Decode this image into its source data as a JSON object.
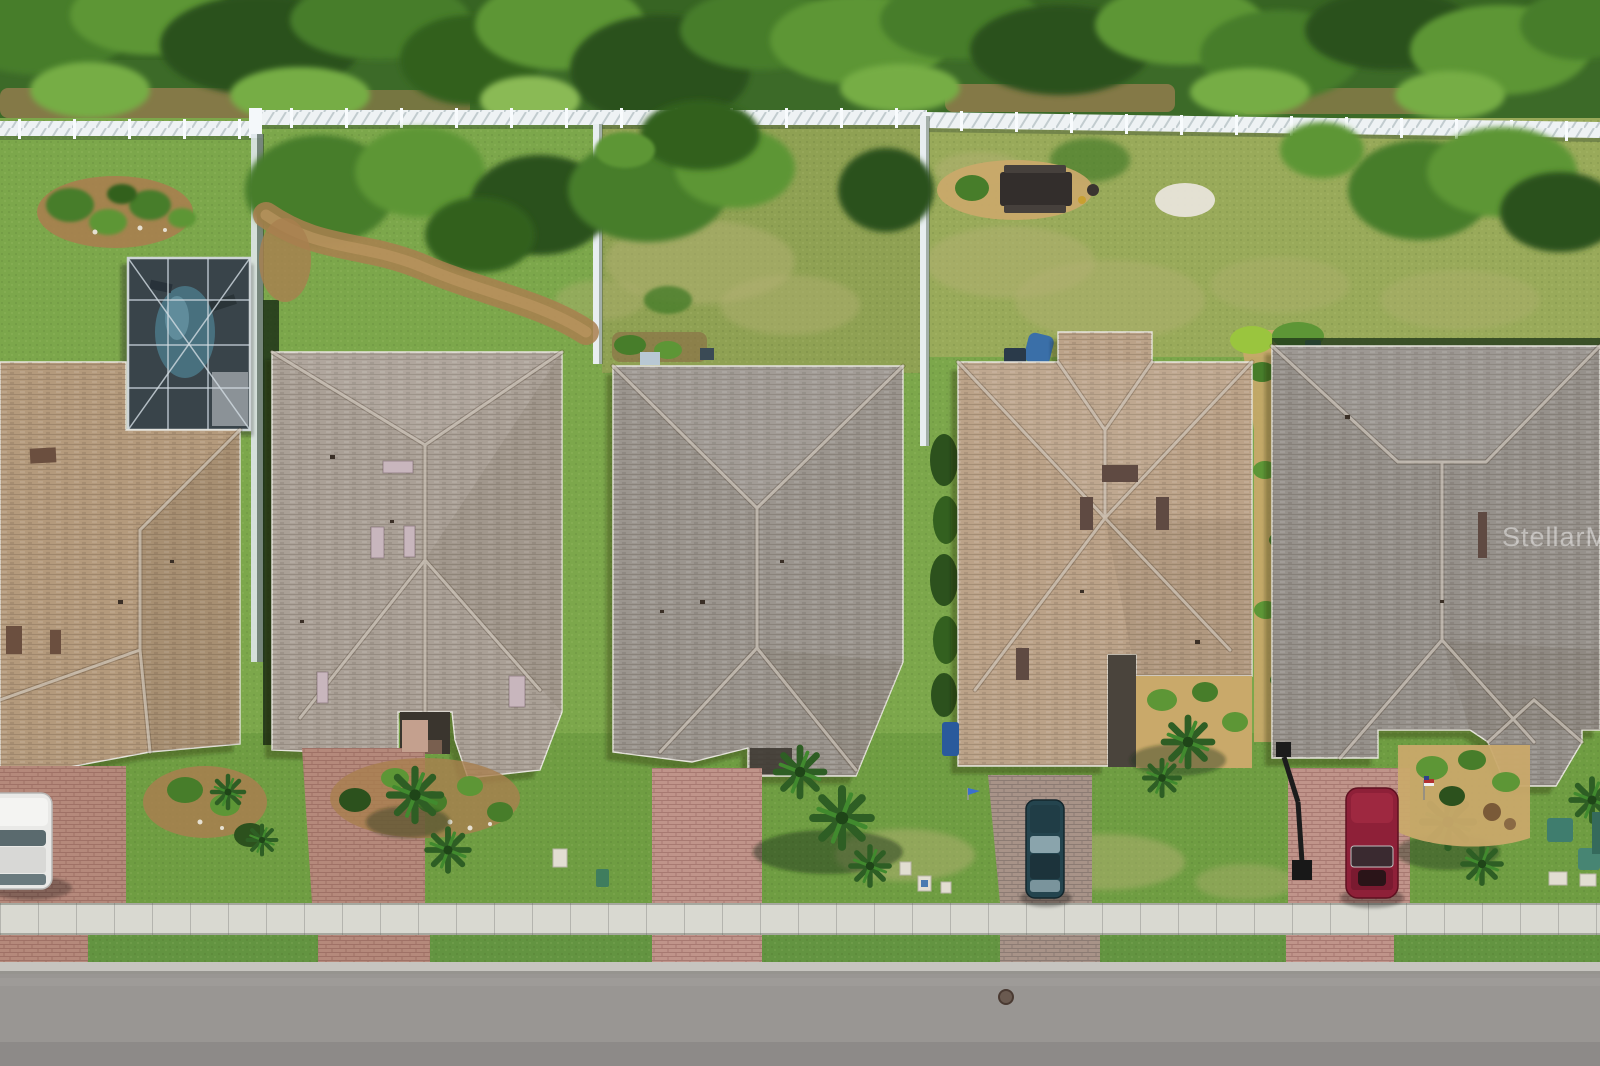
{
  "photo": {
    "kind": "aerial drone photograph, top-down nadir view",
    "subject": "Row of five single-family shingle-roof homes between a wooded preserve with a white privacy fence (top) and a residential street with sidewalk (bottom)",
    "watermark": {
      "text": "StellarMLS",
      "color": "#ffffff",
      "opacity": "0.45"
    }
  },
  "palette": {
    "canopy_base": "#3c6a28",
    "grass_back": "#7ca74b",
    "grass_field": "#9cab5c",
    "grass_patchy": "#93a055",
    "grass_front": "#6f9d42",
    "grass_parkway": "#639441",
    "dirt": "#9c7f52",
    "fence_white": "#eef2f4",
    "roof_house1": "#b49a7c",
    "roof_house2": "#aaa096",
    "roof_house3": "#9b958e",
    "roof_house4": "#bba288",
    "roof_house5": "#96918b",
    "paver_red": "#b5897b",
    "paver_pink": "#c0948a",
    "driveway_gray": "#a89388",
    "sidewalk": "#d9d9d1",
    "curb": "#c6c4bf",
    "road": "#999693",
    "road_lower": "#8d8a88",
    "pool_cage": "#39444a",
    "pool_water": "#48707e",
    "mulch_gold": "#c9a96a",
    "mulch_brown": "#a97f4f",
    "car_white": "#e9e9e7",
    "car_teal": "#24444e",
    "car_red": "#8e2038",
    "utility_teal": "#3f7d6e",
    "lamp_black": "#1c1c1c",
    "manhole": "#6a5a50"
  },
  "scene": {
    "tree_line": "dense preserve of mixed green trees along the entire top edge",
    "back_fence": "continuous white vinyl privacy fence between the tree line and the backyards",
    "side_fences": [
      "white side fence between lot 1 and lot 2",
      "white fencing fully enclosing lot 3 backyard"
    ],
    "houses": [
      {
        "name": "house-1",
        "roof": "tan-brown shingle hip roof",
        "position": "far left, cropped by edge",
        "features": [
          "screened pool enclosure with pool at rear",
          "paver driveway",
          "white car parked"
        ]
      },
      {
        "name": "house-2",
        "roof": "gray-tan mottled shingle",
        "position": "second from left",
        "features": [
          "five pale skylights",
          "recessed front porch",
          "bay window wing",
          "curved mulch path in backyard"
        ]
      },
      {
        "name": "house-3",
        "roof": "gray shingle",
        "position": "center",
        "features": [
          "fenced backyard with shrubs",
          "wide paver front walk",
          "large palm cluster in front yard"
        ]
      },
      {
        "name": "house-4",
        "roof": "tan-beige shingle",
        "position": "second from right",
        "features": [
          "rear wing with blue kayak behind",
          "picnic table on gold-mulch pad in open backyard",
          "blue bin at side",
          "dark entry walkway",
          "teal sedan in driveway"
        ]
      },
      {
        "name": "house-5",
        "roof": "gray shingle",
        "position": "far right, cropped by edge",
        "features": [
          "octagonal bay roof at front",
          "gold mulch beds",
          "small american flag",
          "maroon sedan in driveway",
          "watermark over roof"
        ]
      }
    ],
    "vehicles": [
      {
        "name": "white-car",
        "location": "driveway of house 1, cropped at left edge"
      },
      {
        "name": "teal-car",
        "location": "driveway of house 4, nose toward house"
      },
      {
        "name": "red-car",
        "location": "driveway of house 5, nose toward house"
      }
    ],
    "street_elements": [
      "concrete sidewalk with expansion joints",
      "grass parkway strip",
      "paver driveway aprons",
      "concrete curb",
      "gray asphalt road",
      "manhole cover lower middle"
    ],
    "objects": [
      "screened pool enclosure",
      "dark picnic table on mulch island",
      "white sand patch in rear field",
      "black street lamp with shadow",
      "blue recycling bin",
      "teal utility cabinets at right edge",
      "white utility markers on lot 3 lawn",
      "landscape island with palms in lot 1 backyard"
    ]
  }
}
